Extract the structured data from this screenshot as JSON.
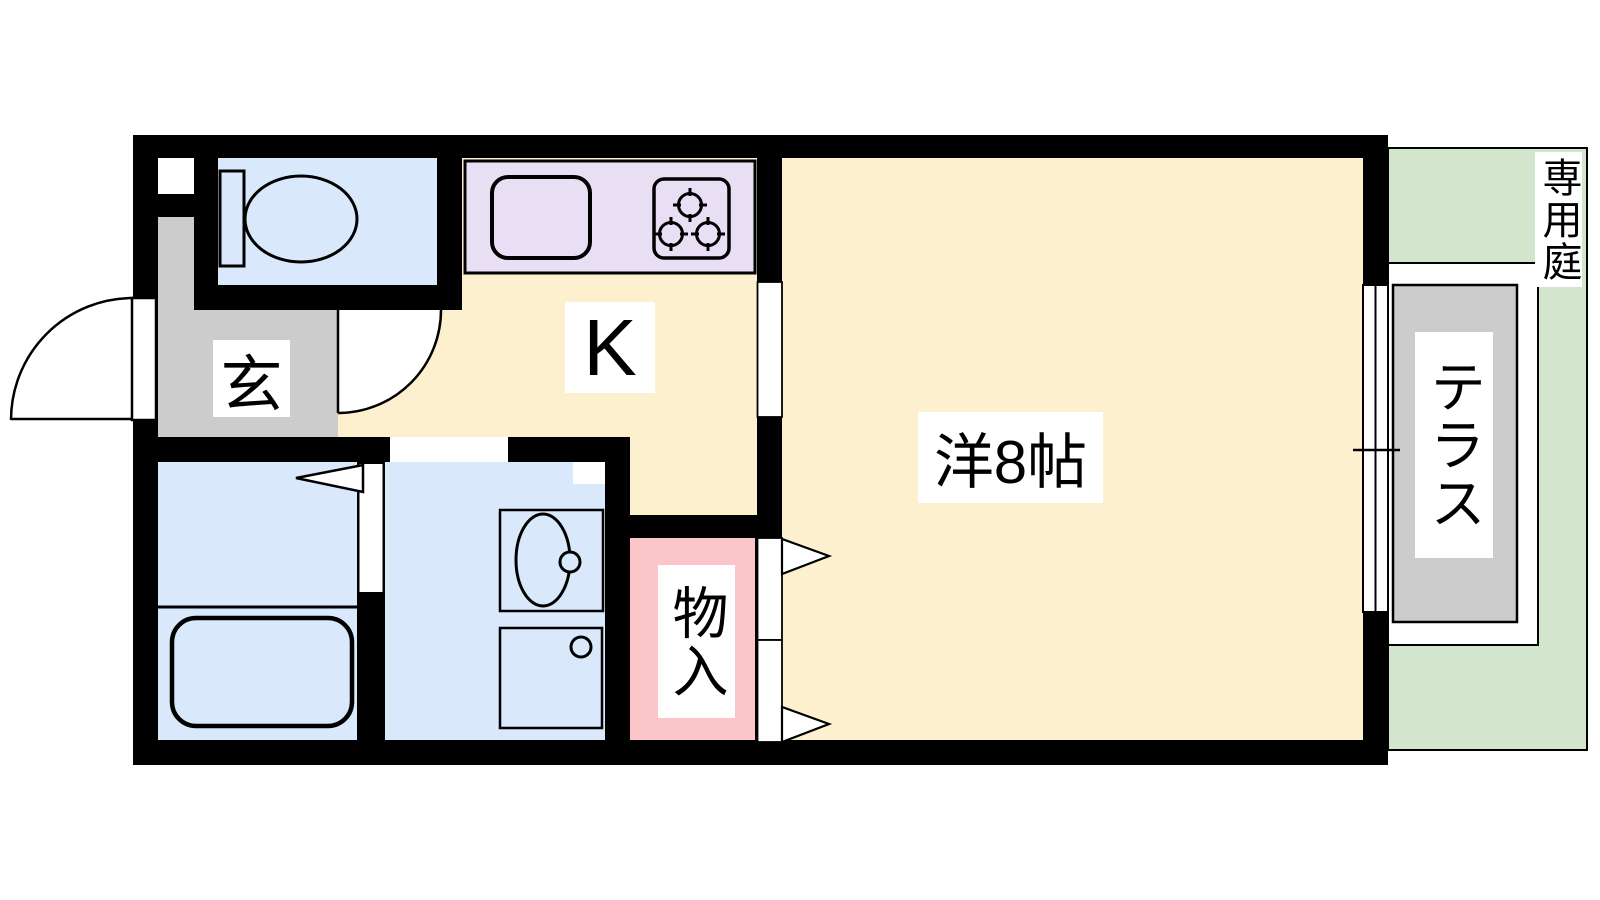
{
  "plan": {
    "type": "apartment-floor-plan",
    "rooms": {
      "entrance": {
        "label": "玄"
      },
      "kitchen": {
        "label": "K"
      },
      "western_room": {
        "label": "洋8帖"
      },
      "closet": {
        "label": "物入"
      },
      "terrace": {
        "label": "テラス"
      },
      "private_garden": {
        "label": "専用庭"
      }
    },
    "fixtures": {
      "toilet": "toilet-icon",
      "bathtub": "bathtub-icon",
      "kitchen_sink": "kitchen-sink-icon",
      "stove": "stove-burners-icon",
      "washbasin": "washbasin-icon",
      "washing_machine": "washing-machine-pan-icon",
      "window": "sliding-window-icon",
      "doors": "door-swing-icon"
    },
    "colors": {
      "wall": "#000000",
      "floor-cream": "#FDF0CE",
      "floor-blue": "#D9E9FB",
      "floor-gray": "#CCCCCC",
      "floor-pink": "#FBC5C9",
      "counter-purple": "#E9DFF4",
      "terrace-gray": "#CCCCCC",
      "garden-green": "#D3E5CD",
      "label-bg": "#FFFFFF",
      "line": "#000000"
    }
  }
}
